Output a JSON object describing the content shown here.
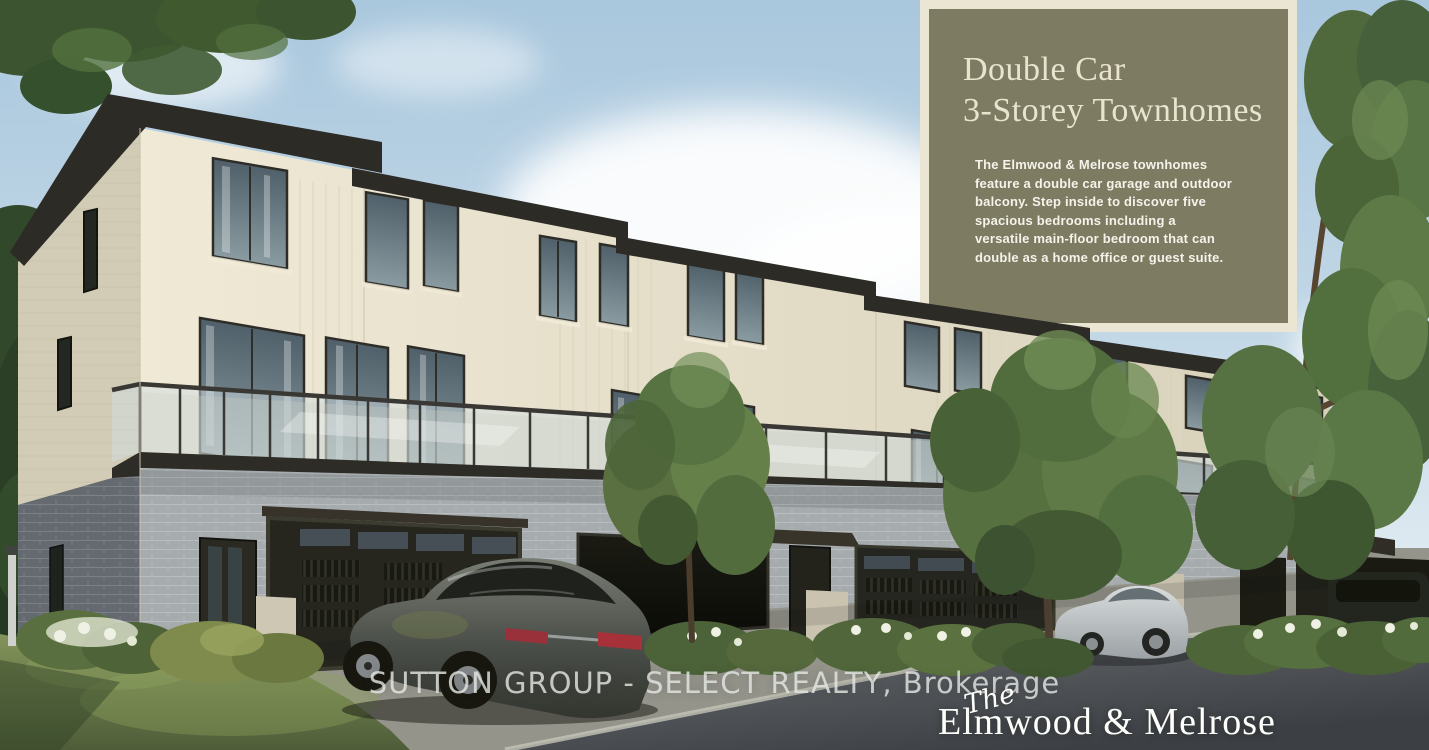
{
  "overlay_panel": {
    "heading_line1": "Double Car",
    "heading_line2": "3-Storey Townhomes",
    "body": "The Elmwood & Melrose townhomes feature a double car garage and outdoor balcony. Step inside to discover five spacious bedrooms including a versatile main-floor bedroom that can double as a home office or guest suite."
  },
  "footer": {
    "brokerage_line": "SUTTON GROUP - SELECT REALTY, Brokerage"
  },
  "logo": {
    "prefix": "The",
    "name": "Elmwood & Melrose"
  },
  "colors": {
    "panel_olive": "#7d7b62",
    "panel_frame": "#ebe5d3",
    "heading_cream": "#e9e4cf",
    "panel_body_text": "#f5f3ea",
    "brokerage_text": "#e2e5e1",
    "logo_white": "#fdfdfa",
    "sky_top": "#a9c7dd",
    "sky_bottom": "#dfeaf1",
    "facade_cream": "#e8e2cd",
    "brick_gray": "#a6abae",
    "roof_dark": "#2c2b26",
    "grass_green": "#72824a",
    "tree_green": "#5c7240",
    "road_gray": "#5f6366"
  }
}
